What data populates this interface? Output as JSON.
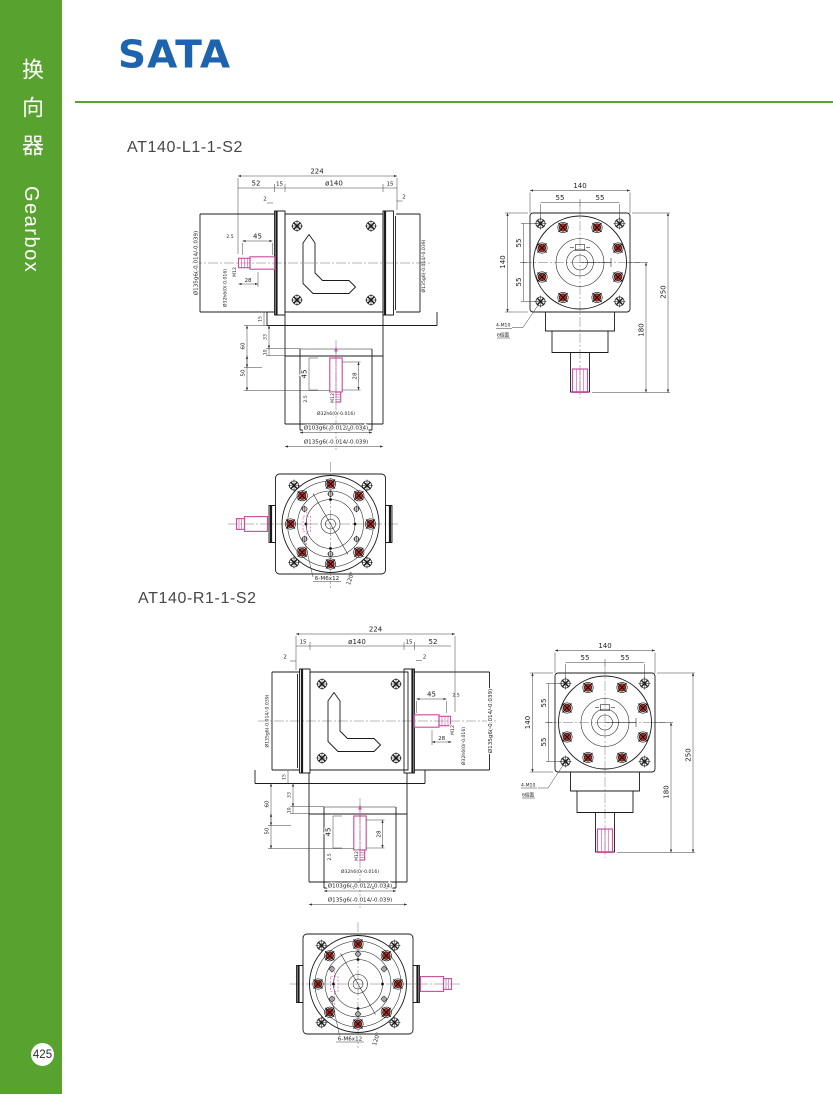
{
  "sidebar": {
    "label_cn": "换向器",
    "label_en": "Gearbox",
    "page_number": "425"
  },
  "header": {
    "brand": "SATA"
  },
  "models": {
    "first": "AT140-L1-1-S2",
    "second": "AT140-R1-1-S2"
  },
  "dims": {
    "d224": "224",
    "d52": "52",
    "d15": "15",
    "o140": "ø140",
    "d2": "2",
    "d2_5": "2.5",
    "d45": "45",
    "d28": "28",
    "m12": "M12",
    "d32h6": "Ø32h6(0/-0.016)",
    "d135g6": "Ø135g6(-0.014/-0.039)",
    "d103g6": "Ø103g6(-0.012/-0.034)",
    "d60": "60",
    "d33": "33",
    "d10": "10",
    "d50": "50",
    "d140": "140",
    "d55": "55",
    "d250": "250",
    "d180": "180",
    "m10_holes": "4-M10",
    "m10_faces": "6個面",
    "m6_holes": "6-M6x12",
    "a120": "120°"
  },
  "colors": {
    "sidebar_green": "#58a22f",
    "brand_blue": "#1e63ae",
    "shaft_pink": "#c9519f",
    "bolt_red": "#c5261f",
    "line": "#1b1b1b"
  }
}
